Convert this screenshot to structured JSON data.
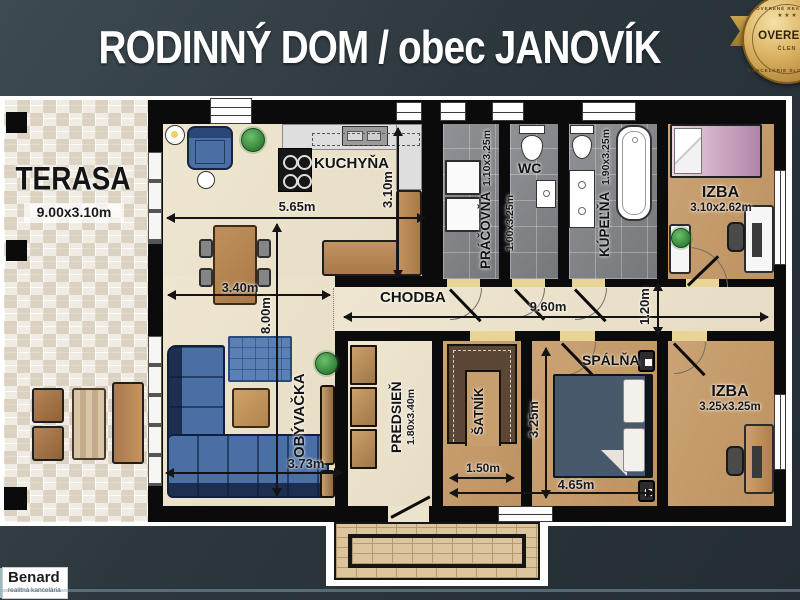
{
  "title": "RODINNÝ DOM / obec JANOVÍK",
  "badge": {
    "arc_top": "OVERENÉ REALITNÉ",
    "stars": "★ ★ ★",
    "main": "OVERENÝ",
    "member": "ČLEN",
    "arc_bottom": "KANCELÁRIE SLOVENSKA"
  },
  "logo": {
    "name": "Benard",
    "tagline": "realitná kancelária"
  },
  "rooms": {
    "terasa": {
      "name": "TERASA",
      "dims": "9.00x3.10m"
    },
    "kuchyna": {
      "name": "KUCHYŇA"
    },
    "pracovna": {
      "name": "PRÁČOVŇA",
      "dims": "1.10x3.25m"
    },
    "wc": {
      "name": "WC",
      "dims": "1.00x3.25m"
    },
    "kupelna": {
      "name": "KÚPEĽŇA",
      "dims": "1.90x3.25m"
    },
    "izba_horna": {
      "name": "IZBA",
      "dims": "3.10x2.62m"
    },
    "chodba": {
      "name": "CHODBA"
    },
    "obyvacka": {
      "name": "OBÝVAČKA"
    },
    "predsien": {
      "name": "PREDSIEŇ",
      "dims": "1.80x3.40m"
    },
    "satnik": {
      "name": "ŠATNÍK"
    },
    "spalna": {
      "name": "SPÁLŇA"
    },
    "izba_dolna": {
      "name": "IZBA",
      "dims": "3.25x3.25m"
    }
  },
  "measurements": {
    "kitchen_width": "5.65m",
    "kitchen_depth": "3.10m",
    "dining_width": "3.40m",
    "living_depth": "8.00m",
    "living_width": "3.73m",
    "hall_length": "9.60m",
    "hall_width": "1.20m",
    "satnik_width": "1.50m",
    "spalna_width": "4.65m",
    "spalna_depth": "3.25m"
  },
  "colors": {
    "background": "#2f3b42",
    "wall": "#0b0b0b",
    "floor_beige": "#ece3cd",
    "floor_tan": "#c79e6e",
    "tile_gray": "#85888b",
    "badge_gold": "#d9b462",
    "sofa_blue": "#4a6fa5",
    "title_text": "#ffffff"
  }
}
